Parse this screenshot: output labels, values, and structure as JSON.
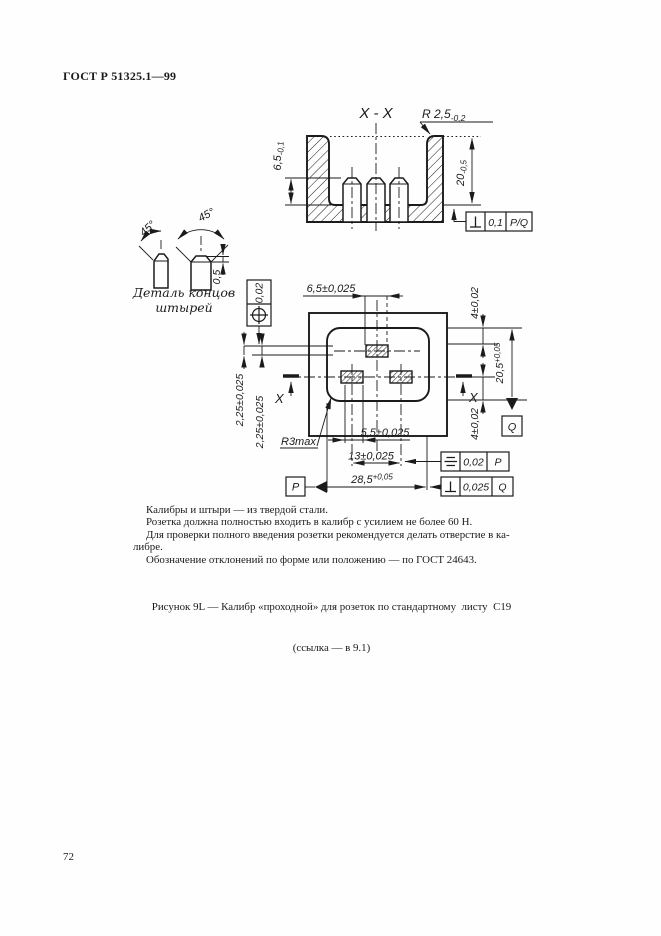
{
  "page": {
    "header": "ГОСТ Р 51325.1—99",
    "page_number": "72"
  },
  "section_view": {
    "title": "X - X",
    "radius_label": "R 2,5",
    "radius_tol": "-0,2",
    "pin_height": "6,5",
    "pin_height_tol": "-0,1",
    "depth": "20",
    "depth_tol": "-0,5",
    "tol_frame": {
      "symbol": "perpendicularity",
      "value": "0,1",
      "datum": "P/Q"
    }
  },
  "pin_detail": {
    "angle_left": "45°",
    "angle_right": "45°",
    "chamfer": "0,5",
    "caption_line1": "Деталь концов",
    "caption_line2": "штырей"
  },
  "plan_view": {
    "dim_top": "6,5±0,025",
    "position_frame": {
      "symbol": "position",
      "value": "0,02"
    },
    "offset1": "2,25±0,025",
    "offset2": "2,25±0,025",
    "dim_right_top": "4±0,02",
    "dim_right_height": "20,5",
    "dim_right_height_tol": "+0,05",
    "dim_right_bottom": "4±0,02",
    "radius_note": "R3max",
    "dim_5_5": "5,5±0,025",
    "dim_13": "13±0,025",
    "dim_28_5": "28,5",
    "dim_28_5_tol": "+0,05",
    "datum_p": "P",
    "datum_q": "Q",
    "section_marker_left": "X",
    "section_marker_right": "X",
    "sym_frame": {
      "symbol": "symmetry",
      "value": "0,02",
      "datum": "P"
    },
    "perp_frame": {
      "symbol": "perpendicularity",
      "value": "0,025",
      "datum": "Q"
    }
  },
  "notes": {
    "line1": "Калибры и штыри — из твердой стали.",
    "line2": "Розетка должна полностью входить в калибр с усилием не более 60 Н.",
    "line3": "Для проверки полного введения розетки рекомендуется делать отверстие в ка-",
    "line4": "либре.",
    "line5": "Обозначение отклонений по форме или положению — по ГОСТ 24643."
  },
  "caption": {
    "line1": "Рисунок 9L — Калибр «проходной» для розеток по стандартному  листу  С19",
    "line2": "(ссылка — в 9.1)"
  },
  "colors": {
    "ink": "#1b1b1b",
    "paper": "#fefefe"
  }
}
